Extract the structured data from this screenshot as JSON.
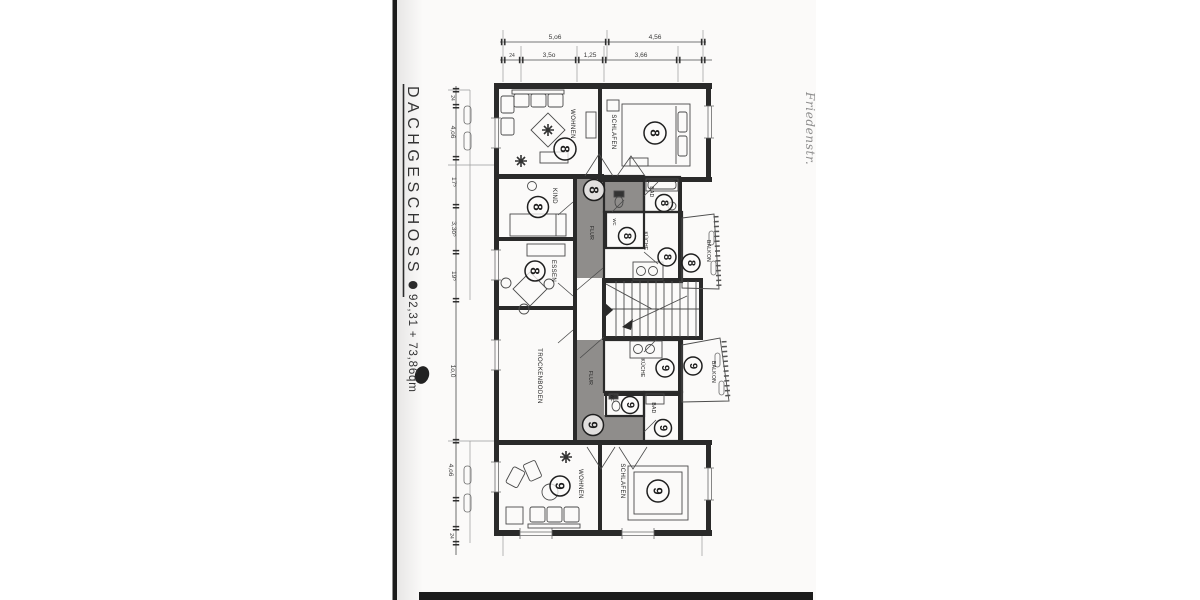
{
  "document": {
    "title": "DACHGESCHOSS",
    "area_text": "92,31 + 73,86qm",
    "handwriting": "Friedenstr."
  },
  "dims": {
    "t1a": "5,o6",
    "t1b": "4,56",
    "t2a": "24",
    "t2b": "3,5o",
    "t2c": "1,25",
    "t2d": "3,66",
    "l1": "24",
    "l2": "4,o6",
    "l3": "17⁵",
    "l4": "3,3o⁵",
    "l5": "19⁵",
    "l6": "1o,0",
    "l7": "4,o6",
    "l8": "24"
  },
  "rooms": {
    "wohnen8": {
      "name": "WOHNEN",
      "unit": "8"
    },
    "schlafen8": {
      "name": "SCHLAFEN",
      "unit": "8"
    },
    "kind8": {
      "name": "KIND",
      "unit": "8"
    },
    "essen8": {
      "name": "ESSEN",
      "unit": "8"
    },
    "flur8": {
      "name": "FLUR",
      "unit": "8"
    },
    "bad8": {
      "name": "BAD",
      "unit": "8"
    },
    "wc8": {
      "name": "WC",
      "unit": "8"
    },
    "kueche8": {
      "name": "KÜCHE",
      "unit": "8"
    },
    "balkon8": {
      "name": "BALKON",
      "unit": "8"
    },
    "trockenboden": {
      "name": "TROCKENBODEN"
    },
    "flur9": {
      "name": "FLUR",
      "unit": "9"
    },
    "kueche9": {
      "name": "KÜCHE",
      "unit": "9"
    },
    "balkon9": {
      "name": "BALKON",
      "unit": "9"
    },
    "wc9": {
      "name": "WC",
      "unit": "9"
    },
    "bad9": {
      "name": "BAD",
      "unit": "9"
    },
    "wohnen9": {
      "name": "WOHNEN",
      "unit": "9"
    },
    "schlafen9": {
      "name": "SCHLAFEN",
      "unit": "9"
    }
  },
  "colors": {
    "corridor_highlight": "#8f8d8b",
    "page": "#fbfaf9",
    "binding_bar": "#1b1b1b"
  }
}
